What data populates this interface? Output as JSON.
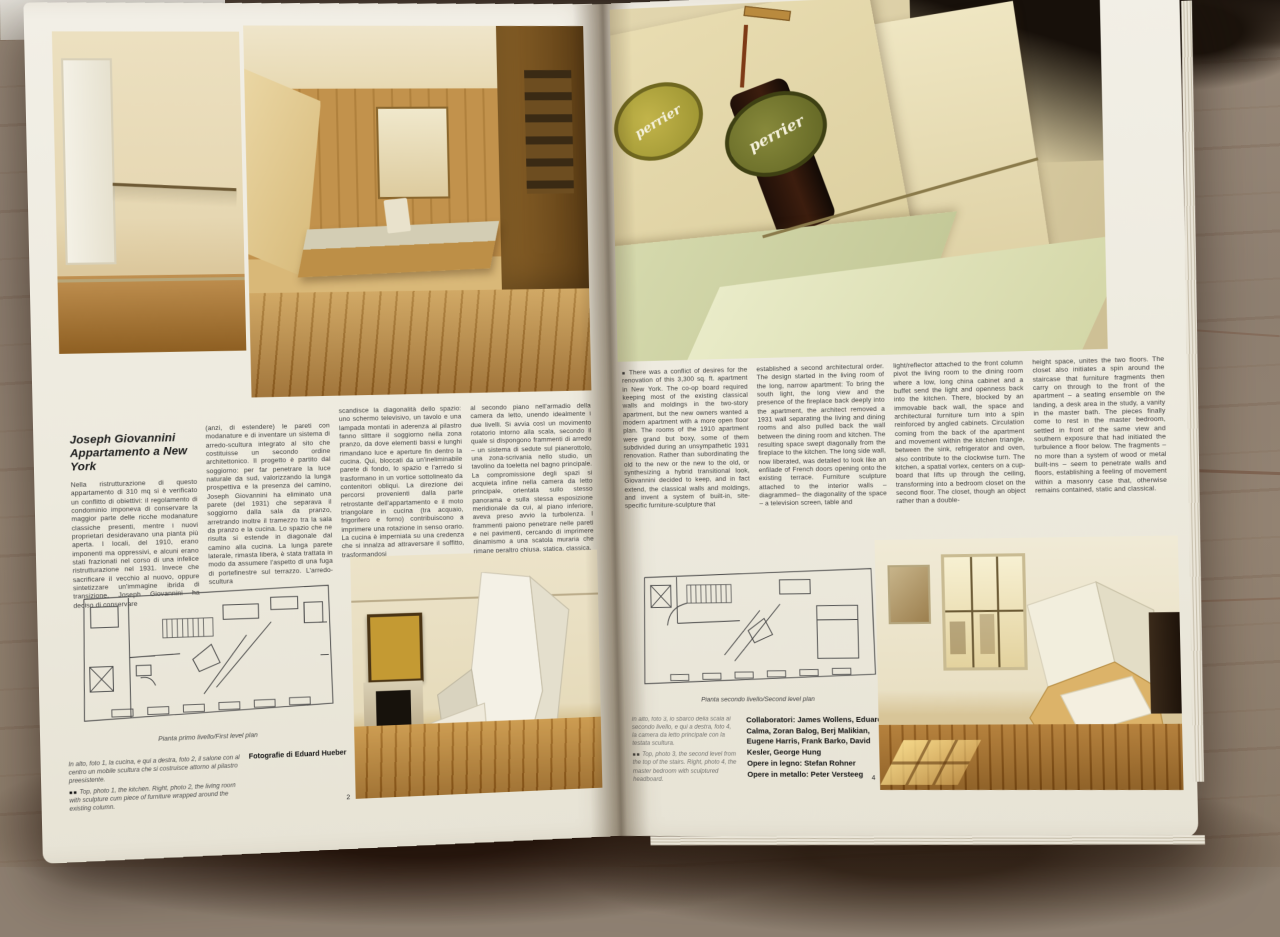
{
  "scene": {
    "background_marble_hex": "#8e8071",
    "top_strip_hex": "#1a120b",
    "page_hex": "#efece2",
    "wood_accent_hex": "#b07c3a",
    "olive_label_hex": "#9a9a38"
  },
  "left_page": {
    "title_line1": "Joseph Giovannini",
    "title_line2": "Appartamento a New York",
    "columns": [
      "Nella ristrutturazione di questo appartamento di 310 mq si è verificato un conflitto di obiettivi: il regolamento di condominio imponeva di conservare la maggior parte delle ricche modanature classiche presenti, mentre i nuovi proprietari desideravano una pianta più aperta. I locali, del 1910, erano imponenti ma oppressivi, e alcuni erano stati frazionati nel corso di una infelice ristrutturazione nel 1931. Invece che sacrificare il vecchio al nuovo, oppure sintetizzare un'immagine ibrida di transizione, Joseph Giovannini ha deciso di conservare",
      "(anzi, di estendere) le pareti con modanature e di inventare un sistema di arredo-scultura integrato al sito che costituisse un secondo ordine architettonico. Il progetto è partito dal soggiorno: per far penetrare la luce naturale da sud, valorizzando la lunga prospettiva e la presenza del camino, Joseph Giovannini ha eliminato una parete (del 1931) che separava il soggiorno dalla sala da pranzo, arretrando inoltre il tramezzo tra la sala da pranzo e la cucina. Lo spazio che ne risulta si estende in diagonale dal camino alla cucina. La lunga parete laterale, rimasta libera, è stata trattata in modo da assumere l'aspetto di una fuga di portefinestre sul terrazzo. L'arredo-scultura",
      "scandisce la diagonalità dello spazio: uno schermo televisivo, un tavolo e una lampada montati in aderenza al pilastro fanno slittare il soggiorno nella zona pranzo, da dove elementi bassi e lunghi rimandano luce e aperture fin dentro la cucina. Qui, bloccati da un'ineliminabile parete di fondo, lo spazio e l'arredo si trasformano in un vortice sottolineato da contenitori obliqui. La direzione dei percorsi provenienti dalla parte retrostante dell'appartamento e il moto triangolare in cucina (tra acquaio, frigorifero e forno) contribuiscono a imprimere una rotazione in senso orario. La cucina è imperniata su una credenza che si innalza ad attraversare il soffitto, trasformandosi",
      "al secondo piano nell'armadio della camera da letto, unendo idealmente i due livelli. Si avvia così un movimento rotatorio intorno alla scala, secondo il quale si dispongono frammenti di arredo – un sistema di sedute sul pianerottolo, una zona-scrivania nello studio, un tavolino da toeletta nel bagno principale. La compromissione degli spazi si acquieta infine nella camera da letto principale, orientata sullo stesso panorama e sulla stessa esposizione meridionale da cui, al piano inferiore, aveva preso avvio la turbolenza. I frammenti paiono penetrare nelle pareti e nei pavimenti, cercando di imprimere dinamismo a una scatola muraria che rimane peraltro chiusa, statica, classica."
    ],
    "plan_caption": "Pianta primo livello/First level plan",
    "caption_it": "In alto, foto 1, la cucina, e qui a destra, foto 2, il salone con al centro un mobile scultura che si costruisce attorno al pilastro preesistente.",
    "caption_marker": "■■",
    "caption_en": "Top, photo 1, the kitchen. Right, photo 2, the living room with sculpture cum piece of furniture wrapped around the existing column.",
    "photo_credit": "Fotografie di Eduard Hueber",
    "photo2_label": "2"
  },
  "right_page": {
    "body_marker": "■",
    "columns": [
      "There was a conflict of desires for the renovation of this 3,300 sq. ft. apartment in New York. The co-op board required keeping most of the existing classical walls and moldings in the two-story apartment, but the new owners wanted a modern apartment with a more open floor plan. The rooms of the 1910 apartment were grand but boxy, some of them subdivided during an unsympathetic 1931 renovation. Rather than subordinating the old to the new or the new to the old, or synthesizing a hybrid transitional look, Giovannini decided to keep, and in fact extend, the classical walls and moldings, and invent a system of built-in, site-specific furniture-sculpture that",
      "established a second architectural order. The design started in the living room of the long, narrow apartment: To bring the south light, the long view and the presence of the fireplace back deeply into the apartment, the architect removed a 1931 wall separating the living and dining rooms and also pulled back the wall between the dining room and kitchen. The resulting space swept diagonally from the fireplace to the kitchen. The long side wall, now liberated, was detailed to look like an enfilade of French doors opening onto the existing terrace. Furniture sculpture attached to the interior walls –diagrammed– the diagonality of the space – a television screen, table and",
      "light/reflector attached to the front column pivot the living room to the dining room where a low, long china cabinet and a buffet send the light and openness back into the kitchen. There, blocked by an immovable back wall, the space and architectural furniture turn into a spin reinforced by angled cabinets. Circulation coming from the back of the apartment and movement within the kitchen triangle, between the sink, refrigerator and oven, also contribute to the clockwise turn. The kitchen, a spatial vortex, centers on a cup-board that lifts up through the ceiling, transforming into a bedroom closet on the second floor. The closet, though an object rather than a double-",
      "height space, unites the two floors. The closet also initiates a spin around the staircase that furniture fragments then carry on through to the front of the apartment – a seating ensemble on the landing, a desk area in the study, a vanity in the master bath. The pieces finally come to rest in the master bedroom, settled in front of the same view and southern exposure that had initiated the turbulence a floor below. The fragments – no more than a system of wood or metal built-ins – seem to penetrate walls and floors, establishing a feeling of movement within a masonry case that, otherwise remains contained, static and classical."
    ],
    "plan_caption": "Pianta secondo livello/Second level plan",
    "caption_it": "In alto, foto 3, lo sbarco della scala al secondo livello, e qui a destra, foto 4, la camera da letto principale con la testata scultura.",
    "caption_marker": "■■",
    "caption_en": "Top, photo 3, the second level from the top of the stairs. Right, photo 4, the master bedroom with sculptured headboard.",
    "collaborators_line1": "Collaboratori: James Wollens, Eduard Calma, Zoran Balog, Berj Malikian, Eugene Harris, Frank Barko, David Kesler, George Hung",
    "collaborators_line2": "Opere in legno: Stefan Rohner",
    "collaborators_line3": "Opere in metallo: Peter Versteeg",
    "photo4_label": "4",
    "artwork_brand": "perrier"
  }
}
